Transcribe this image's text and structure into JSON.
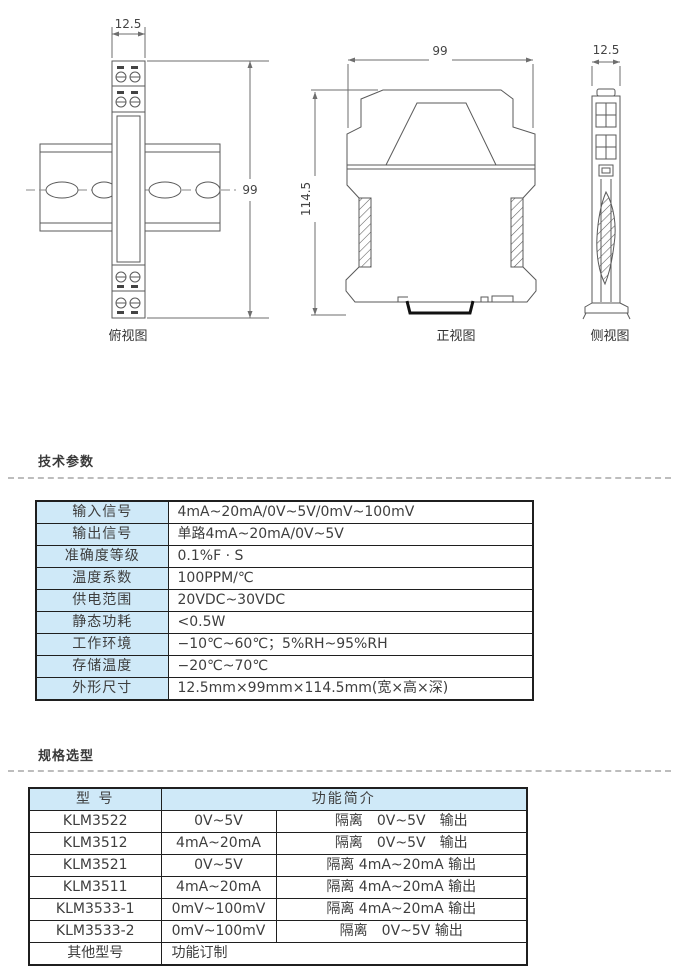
{
  "colors": {
    "header_blue": "#cfe9f8",
    "table_border": "#1f1f1f",
    "text": "#3e3e3e",
    "drawing_line": "#5a5a5a",
    "dash_divider": "#bdbdbd"
  },
  "drawings": {
    "top_view": {
      "label": "俯视图",
      "dim_w": "12.5",
      "dim_h": "99"
    },
    "front_view": {
      "label": "正视图",
      "dim_w": "99",
      "dim_h": "114.5"
    },
    "side_view": {
      "label": "侧视图",
      "dim_w": "12.5"
    }
  },
  "tech": {
    "heading": "技术参数",
    "rows": [
      {
        "label": "输入信号",
        "value": "4mA~20mA/0V~5V/0mV~100mV"
      },
      {
        "label": "输出信号",
        "value": "单路4mA~20mA/0V~5V"
      },
      {
        "label": "准确度等级",
        "value": "0.1%F · S"
      },
      {
        "label": "温度系数",
        "value": "100PPM/℃"
      },
      {
        "label": "供电范围",
        "value": "20VDC~30VDC"
      },
      {
        "label": "静态功耗",
        "value": "<0.5W"
      },
      {
        "label": "工作环境",
        "value": "−10℃~60℃；5%RH~95%RH"
      },
      {
        "label": "存储温度",
        "value": "−20℃~70℃"
      },
      {
        "label": "外形尺寸",
        "value": "12.5mm×99mm×114.5mm(宽×高×深)"
      }
    ]
  },
  "spec": {
    "heading": "规格选型",
    "col_model": "型 号",
    "col_desc": "功能简介",
    "rows": [
      {
        "model": "KLM3522",
        "input": "0V~5V",
        "output": "隔离　0V~5V　输出"
      },
      {
        "model": "KLM3512",
        "input": "4mA~20mA",
        "output": "隔离　0V~5V　输出"
      },
      {
        "model": "KLM3521",
        "input": "0V~5V",
        "output": "隔离 4mA~20mA 输出"
      },
      {
        "model": "KLM3511",
        "input": "4mA~20mA",
        "output": "隔离 4mA~20mA 输出"
      },
      {
        "model": "KLM3533-1",
        "input": "0mV~100mV",
        "output": "隔离 4mA~20mA 输出"
      },
      {
        "model": "KLM3533-2",
        "input": "0mV~100mV",
        "output": "隔离　0V~5V 输出"
      }
    ],
    "last_row": {
      "model": "其他型号",
      "desc": "功能订制"
    }
  }
}
